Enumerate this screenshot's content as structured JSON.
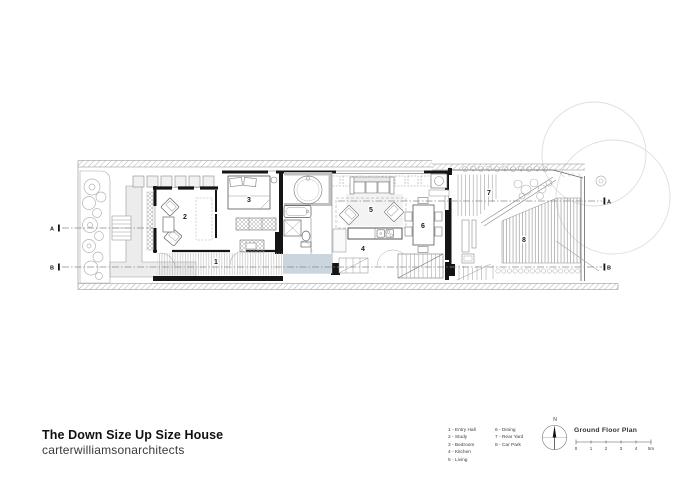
{
  "title_block": {
    "project": "The Down Size Up Size House",
    "studio": "carterwilliamsonarchitects"
  },
  "legend": {
    "column1": [
      "1 - Entry Hall",
      "2 - Study",
      "3 - Bedroom",
      "4 - Kitchen",
      "5 - Living"
    ],
    "column2": [
      "6 - Dining",
      "7 - Rear Yard",
      "8 - Car Park"
    ]
  },
  "plan": {
    "title": "Ground Floor Plan",
    "room_numbers": [
      "1",
      "2",
      "3",
      "4",
      "5",
      "6",
      "7",
      "8"
    ],
    "section_markers": {
      "a": "A",
      "b": "B"
    },
    "north_label": "N",
    "scale_ticks": [
      "0",
      "1",
      "2",
      "3",
      "4",
      "5m"
    ]
  },
  "colors": {
    "pool": "#cbd5dd",
    "wall": "#141414",
    "line": "#555555"
  }
}
